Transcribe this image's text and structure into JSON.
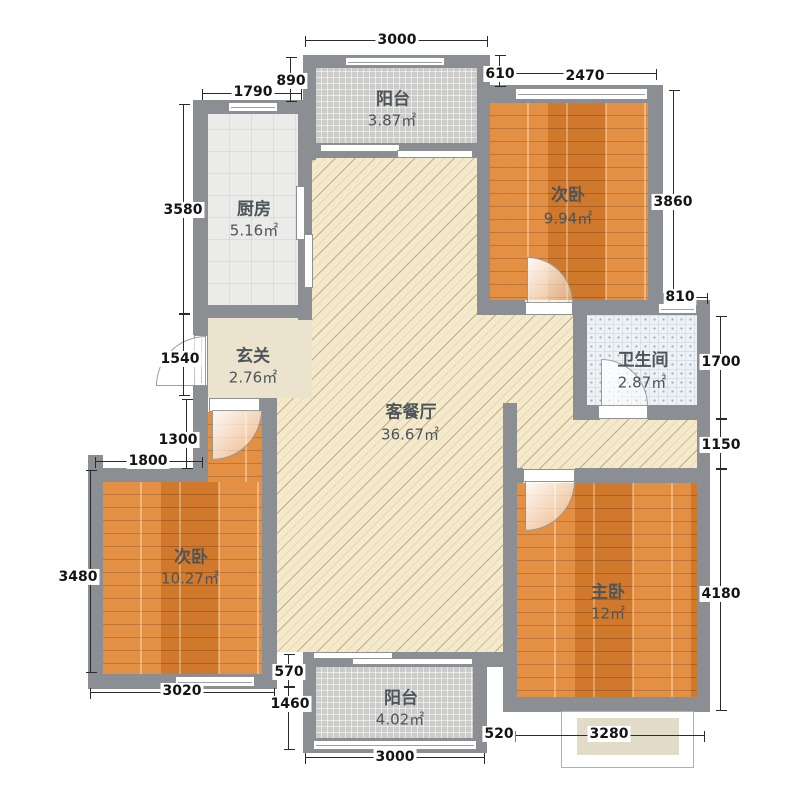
{
  "plan": {
    "rooms": [
      {
        "key": "balcony-top",
        "name": "阳台",
        "area": "3.87㎡"
      },
      {
        "key": "kitchen",
        "name": "厨房",
        "area": "5.16㎡"
      },
      {
        "key": "bedroom-second-top",
        "name": "次卧",
        "area": "9.94㎡"
      },
      {
        "key": "bathroom",
        "name": "卫生间",
        "area": "2.87㎡"
      },
      {
        "key": "entry-hall",
        "name": "玄关",
        "area": "2.76㎡"
      },
      {
        "key": "living-dining",
        "name": "客餐厅",
        "area": "36.67㎡"
      },
      {
        "key": "bedroom-second-left",
        "name": "次卧",
        "area": "10.27㎡"
      },
      {
        "key": "master-bedroom",
        "name": "主卧",
        "area": "12㎡"
      },
      {
        "key": "balcony-bottom",
        "name": "阳台",
        "area": "4.02㎡"
      }
    ],
    "dimensions_mm": {
      "balcony_top_width": "3000",
      "kitchen_window_width": "1790",
      "kitchen_setback": "890",
      "bedroom_top_setback": "610",
      "bedroom_top_width": "2470",
      "kitchen_depth": "3580",
      "entry_section_height": "1540",
      "bedroom_left_notch_height": "1300",
      "bedroom_left_top_width": "1800",
      "bedroom_left_depth": "3480",
      "bedroom_left_width": "3020",
      "bedroom_top_depth": "3860",
      "bath_top_offset": "810",
      "bath_depth": "1700",
      "living_right_strip": "1150",
      "master_depth": "4180",
      "balcony_bottom_offset": "570",
      "balcony_bottom_depth": "1460",
      "balcony_bottom_width": "3000",
      "master_left_offset": "520",
      "bay_window_width": "3280"
    },
    "colors": {
      "wall": "#8b8e92",
      "wood_floor": "#e0822f",
      "living_floor": "#f4eacb",
      "kitchen_floor": "#ebebe9",
      "balcony_floor": "#cbcbc9",
      "bath_floor": "#eef2f5",
      "entry_floor": "#ece3cf",
      "dimension_text": "#141414"
    }
  }
}
